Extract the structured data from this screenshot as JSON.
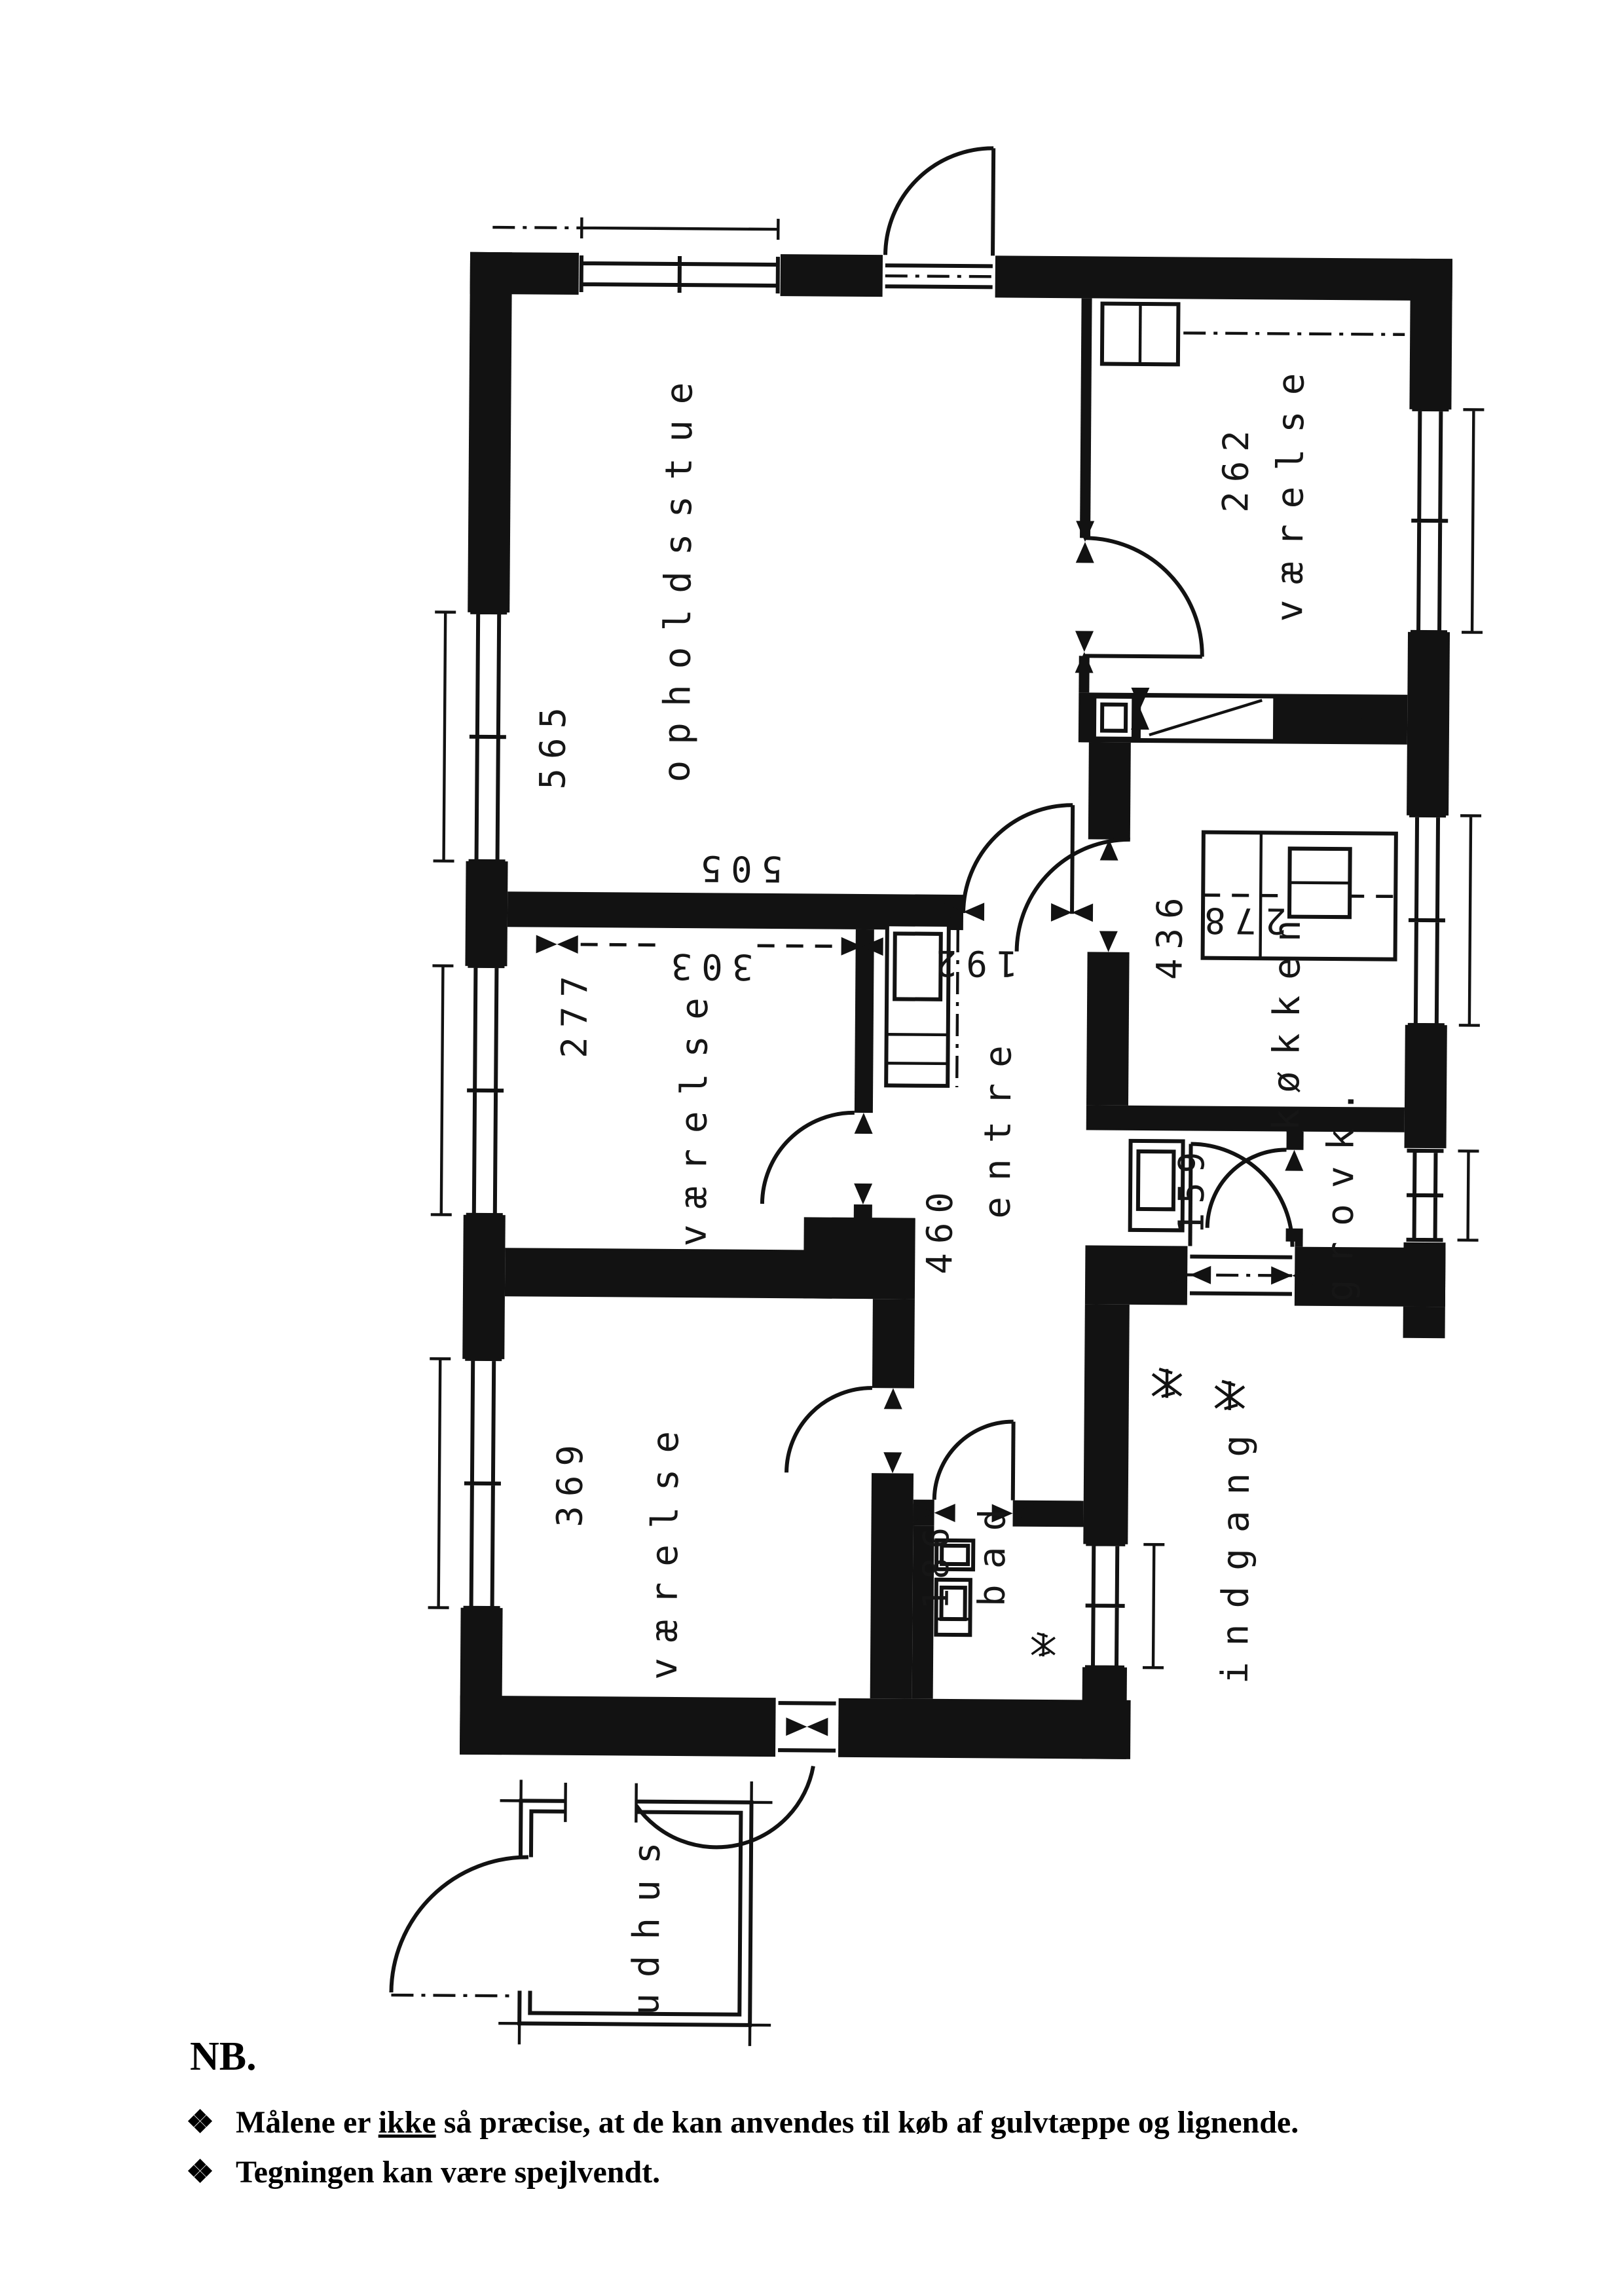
{
  "document": {
    "type": "scanned floor plan",
    "ink_color": "#121212",
    "paper_color": "#ffffff"
  },
  "rooms": {
    "opholdsstue": {
      "name": "opholdsstue",
      "width": "565",
      "depth": "505"
    },
    "vaerelse_ne": {
      "name": "værelse",
      "width": "262"
    },
    "koekken": {
      "name": "køkken",
      "width": "436",
      "counter": "278"
    },
    "grovk": {
      "name": "grovk.",
      "dim": "159"
    },
    "entre": {
      "name": "entre",
      "depth": "460",
      "opening": "192"
    },
    "vaerelse_mid": {
      "name": "værelse",
      "width": "277",
      "depth": "303"
    },
    "vaerelse_sw": {
      "name": "værelse",
      "width": "369"
    },
    "bad": {
      "name": "bad",
      "width": "186"
    },
    "indgang": {
      "name": "indgang"
    },
    "udhus": {
      "name": "udhus"
    }
  },
  "notes": {
    "heading": "NB.",
    "bullet": "❖",
    "note1_prefix": "Målene er ",
    "note1_underlined": "ikke",
    "note1_suffix": " så præcise, at de kan anvendes til køb af gulvtæppe og lignende.",
    "note2": "Tegningen kan være spejlvendt."
  }
}
